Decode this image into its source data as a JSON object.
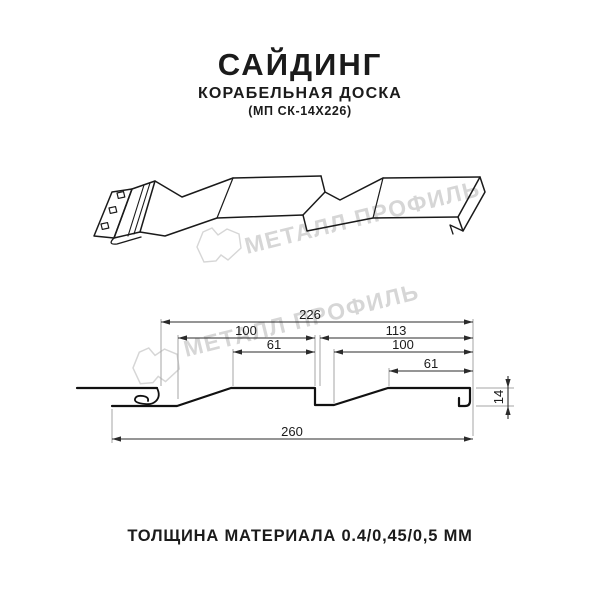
{
  "title": {
    "main": "САЙДИНГ",
    "subtitle": "КОРАБЕЛЬНАЯ ДОСКА",
    "code": "(МП СК-14Х226)"
  },
  "footer": {
    "thickness_label": "ТОЛЩИНА МАТЕРИАЛА 0.4/0,45/0,5 ММ"
  },
  "watermark": {
    "brand": "МЕТАЛЛ ПРОФИЛЬ",
    "color": "#d6d6d6"
  },
  "cross_section": {
    "dimensions_mm": {
      "coverage": "226",
      "panel1": "100",
      "panel2": "113",
      "flat1": "61",
      "flat2": "100",
      "flat2_small": "61",
      "overall": "260",
      "height": "14"
    }
  },
  "colors": {
    "line_art": "#1a1a1a",
    "profile": "#111111",
    "dimension_line": "#2b2b2b",
    "extension_line": "#a5a5a5"
  }
}
